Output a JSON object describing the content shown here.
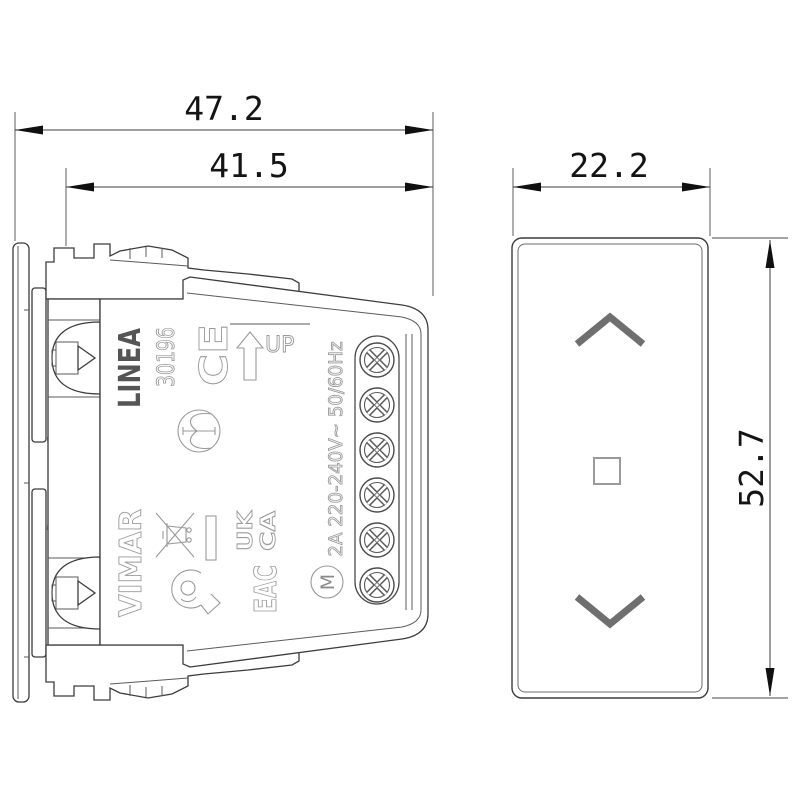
{
  "dimensions": {
    "overall_depth": "47.2",
    "mount_depth": "41.5",
    "front_width": "22.2",
    "front_height": "52.7"
  },
  "side_view": {
    "brand": "LINEA",
    "model_number": "30196",
    "maker": "VIMAR",
    "ce_mark": "CE",
    "up_label": "UP",
    "ukca_line1": "UK",
    "ukca_line2": "CA",
    "eac_mark": "EAC",
    "motor_symbol": "M",
    "rating": "2A 220-240V~ 50/60Hz",
    "screw_count": 6
  },
  "front_view": {
    "up_control": "chevron-up",
    "stop_control": "square",
    "down_control": "chevron-down"
  },
  "icons": {
    "up_arrow": "block-arrow-up-icon",
    "weee": "crossed-out-bin-icon",
    "insulation": "circle-symbol-icon",
    "horn": "horn-certification-icon",
    "motor": "circle-m-icon",
    "screw": "cross-screw-icon",
    "chevron_up": "chevron-up-icon",
    "chevron_down": "chevron-down-icon",
    "square": "square-outline-icon"
  },
  "colors": {
    "outline": "#3c3c3c",
    "mark_gray": "#9a9a9a",
    "brand_gray": "#555555",
    "chevron_gray": "#6f6f6f",
    "dimension_black": "#141414",
    "background": "#ffffff"
  }
}
